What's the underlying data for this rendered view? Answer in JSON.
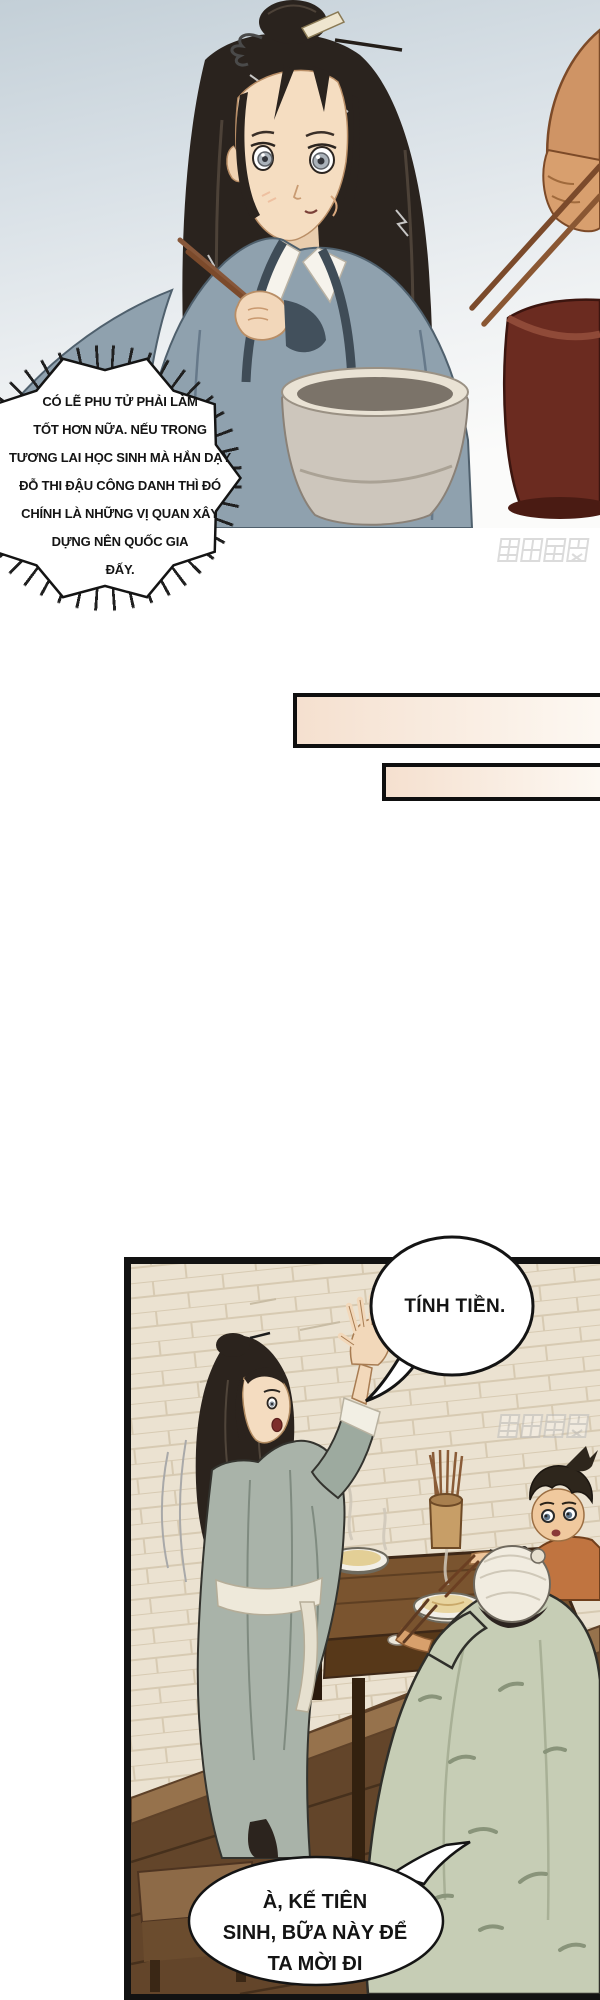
{
  "page": {
    "kind": "manhua-comic-page",
    "width": 600,
    "height": 2000
  },
  "bubbles": {
    "burst": {
      "style": "burst-shout",
      "lines": [
        "CÓ LẼ PHU TỬ PHẢI LÀM",
        "TỐT HƠN NỮA. NẾU TRONG",
        "TƯƠNG LAI HỌC SINH MÀ HẮN DẠY",
        "ĐỖ THI ĐẬU CÔNG DANH THÌ ĐÓ",
        "CHÍNH LÀ NHỮNG VỊ QUAN XÂY",
        "DỰNG NÊN QUỐC GIA",
        "ĐẤY."
      ]
    },
    "tinh_tien": {
      "style": "oval",
      "text": "TÍNH TIỀN."
    },
    "treat": {
      "style": "oval",
      "lines": [
        "À, KẾ TIÊN",
        "SINH, BỮA NÀY ĐỂ",
        "TA MỜI ĐI"
      ]
    }
  },
  "watermark": {
    "text": "腾讯动漫",
    "occurrences": 2
  },
  "colors": {
    "panel_border": "#121212",
    "bubble_stroke": "#141414",
    "bar_fill_left": "#f5e0cf",
    "bar_fill_right": "#fdf8f2",
    "sky_top": "#c3cfd7",
    "stone_floor": "#ebe2d1",
    "wood_floor": "#63452a",
    "robe_top_character": "#8fa1ae",
    "robe_standing_character": "#a9b3a9",
    "robe_seated_man": "#c6cdb5",
    "kid_clothes": "#c07440",
    "red_bowl": "#6b2b20"
  }
}
